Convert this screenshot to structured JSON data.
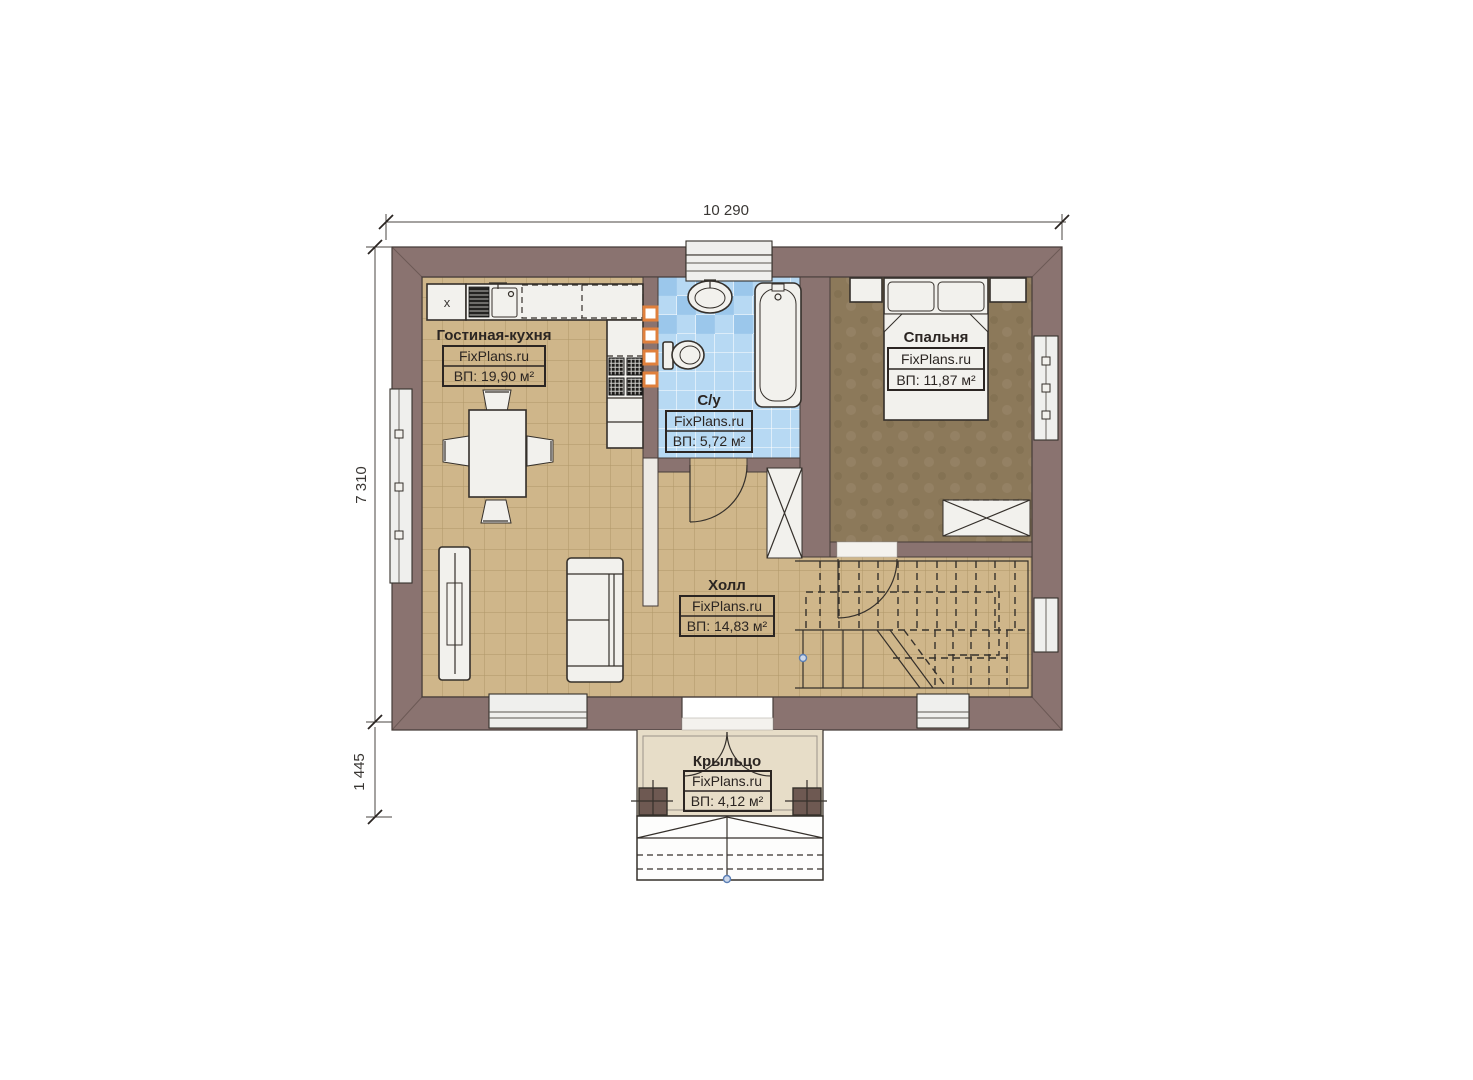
{
  "dimensions": {
    "width_top": "10 290",
    "height_left": "7 310",
    "porch_depth": "1 445"
  },
  "rooms": {
    "living": {
      "name": "Гостиная-кухня",
      "brand": "FixPlans.ru",
      "area": "ВП: 19,90 м²"
    },
    "bathroom": {
      "name": "С/у",
      "brand": "FixPlans.ru",
      "area": "ВП: 5,72 м²"
    },
    "bedroom": {
      "name": "Спальня",
      "brand": "FixPlans.ru",
      "area": "ВП: 11,87 м²"
    },
    "hall": {
      "name": "Холл",
      "brand": "FixPlans.ru",
      "area": "ВП: 14,83 м²"
    },
    "porch": {
      "name": "Крыльцо",
      "brand": "FixPlans.ru",
      "area": "ВП: 4,12 м²"
    }
  },
  "labels": {
    "appliance_x": "x"
  },
  "colors": {
    "wall": "#8a7370",
    "floor_tile": "#cfb68a",
    "floor_grid": "#a8905f",
    "bedroom_floor": "#8c795a",
    "bathroom_tile": "#b7d9f3",
    "bathroom_tile_dark": "#96c4ea",
    "porch_floor": "#e7ddc8",
    "accent_orange": "#e0803d",
    "line": "#35302b",
    "window": "#efefed",
    "marker_blue": "#5b7fb5"
  }
}
